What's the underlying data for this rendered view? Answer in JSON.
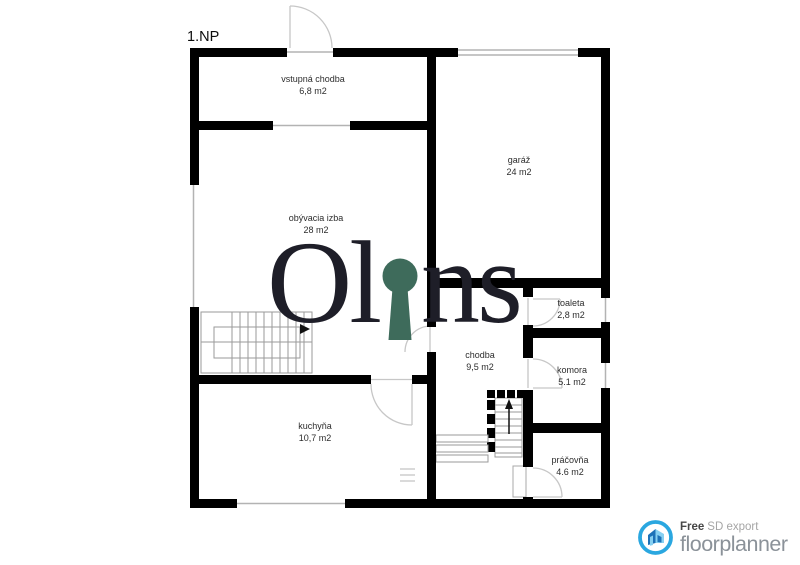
{
  "plan": {
    "floor_label": "1.NP"
  },
  "rooms": [
    {
      "name": "vstupná chodba",
      "area": "6,8 m2"
    },
    {
      "name": "obývacia izba",
      "area": "28 m2"
    },
    {
      "name": "garáž",
      "area": "24 m2"
    },
    {
      "name": "toaleta",
      "area": "2,8 m2"
    },
    {
      "name": "chodba",
      "area": "9,5 m2"
    },
    {
      "name": "komora",
      "area": "5.1 m2"
    },
    {
      "name": "kuchyňa",
      "area": "10,7 m2"
    },
    {
      "name": "práčovňa",
      "area": "4.6 m2"
    }
  ],
  "watermark": {
    "left": "Ol",
    "right": "ns",
    "keyhole_color": "#3e6b5b",
    "text_color": "#1e1e28"
  },
  "footer": {
    "free_label": "Free",
    "export_label": "SD export",
    "brand": "floorplanner",
    "badge_color": "#2aa7e0",
    "brand_color": "#8b9299"
  },
  "colors": {
    "wall": "#000000",
    "thin_line": "#b3b3b3",
    "door_arc": "#c7c7c7"
  }
}
